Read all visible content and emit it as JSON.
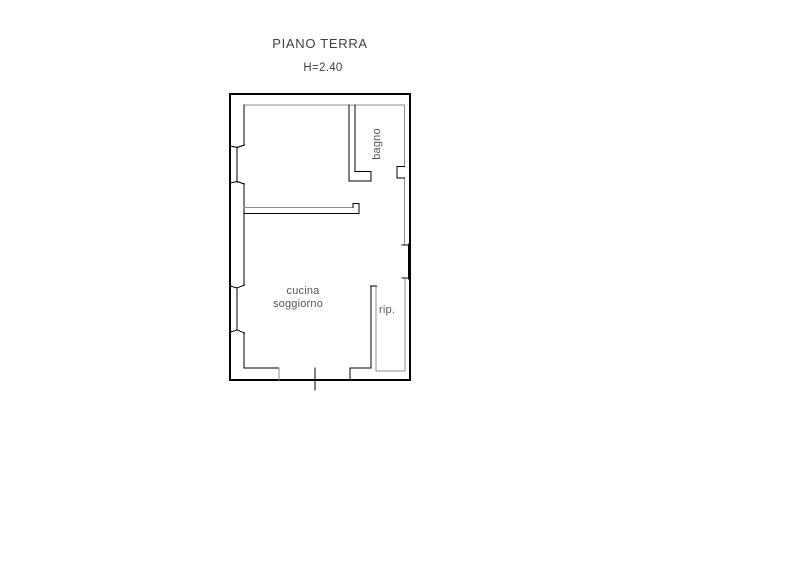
{
  "title": "PIANO TERRA",
  "subtitle": "H=2.40",
  "colors": {
    "background": "#ffffff",
    "line_main": "#000000",
    "line_secondary": "#8c8c8c",
    "text": "#3f3f3f"
  },
  "floorplan": {
    "labels": [
      {
        "id": "bagno",
        "text": "bagno"
      },
      {
        "id": "cucina",
        "text": "cucina"
      },
      {
        "id": "soggiorno",
        "text": "soggiorno"
      },
      {
        "id": "rip",
        "text": "rip."
      }
    ],
    "segments": [
      {
        "p": [
          230,
          94,
          410,
          94
        ],
        "c": "m",
        "w": 1.6,
        "part": "outer-wall-top"
      },
      {
        "p": [
          410,
          94,
          410,
          380
        ],
        "c": "m",
        "w": 1.6,
        "part": "outer-wall-right"
      },
      {
        "p": [
          410,
          380,
          230,
          380
        ],
        "c": "m",
        "w": 1.6,
        "part": "outer-wall-bottom"
      },
      {
        "p": [
          230,
          380,
          230,
          94
        ],
        "c": "m",
        "w": 1.6,
        "part": "outer-wall-left"
      },
      {
        "p": [
          244,
          105,
          404.5,
          105
        ],
        "c": "s",
        "w": 1.2,
        "part": "inner-wall-top"
      },
      {
        "p": [
          244,
          105,
          244,
          145
        ],
        "c": "m",
        "w": 1.2,
        "part": "inner-wall-left"
      },
      {
        "p": [
          244,
          184,
          244,
          285
        ],
        "c": "m",
        "w": 1.2,
        "part": "inner-wall-left"
      },
      {
        "p": [
          244,
          333,
          244,
          368
        ],
        "c": "m",
        "w": 1.2,
        "part": "inner-wall-left"
      },
      {
        "p": [
          404.5,
          105,
          404.5,
          166.5
        ],
        "c": "s",
        "w": 1.2,
        "part": "inner-wall-right"
      },
      {
        "p": [
          404.5,
          178,
          404.5,
          245
        ],
        "c": "s",
        "w": 1.2,
        "part": "inner-wall-right"
      },
      {
        "p": [
          405,
          278,
          405,
          371
        ],
        "c": "s",
        "w": 1.2,
        "part": "inner-wall-right"
      },
      {
        "p": [
          244,
          368,
          279,
          368
        ],
        "c": "m",
        "w": 1.2,
        "part": "inner-wall-bottom"
      },
      {
        "p": [
          279,
          368,
          279,
          380
        ],
        "c": "s",
        "w": 1.2,
        "part": "entrance-jamb-left"
      },
      {
        "p": [
          350,
          368,
          350,
          380
        ],
        "c": "m",
        "w": 1.2,
        "part": "entrance-jamb-right"
      },
      {
        "p": [
          350,
          368,
          371,
          368
        ],
        "c": "m",
        "w": 1.2,
        "part": "inner-wall-bottom"
      },
      {
        "p": [
          376,
          371,
          405,
          371
        ],
        "c": "s",
        "w": 1.2,
        "part": "closet-floor-line"
      },
      {
        "p": [
          315,
          368,
          315,
          390
        ],
        "c": "m",
        "w": 1.2,
        "part": "entrance-door-axis"
      },
      {
        "p": [
          237,
          147,
          237,
          182
        ],
        "c": "m",
        "w": 1.1,
        "part": "window-1-pane"
      },
      {
        "p": [
          230.5,
          146,
          237,
          147.5
        ],
        "c": "m",
        "w": 1.0,
        "part": "window-1-jamb-top"
      },
      {
        "p": [
          237,
          147.5,
          244.5,
          145
        ],
        "c": "m",
        "w": 1.0,
        "part": "window-1-jamb-top"
      },
      {
        "p": [
          237,
          181.5,
          244.5,
          184
        ],
        "c": "m",
        "w": 1.0,
        "part": "window-1-jamb-bottom"
      },
      {
        "p": [
          230.5,
          183,
          237,
          181.5
        ],
        "c": "m",
        "w": 1.0,
        "part": "window-1-jamb-bottom"
      },
      {
        "p": [
          237,
          288,
          237,
          330
        ],
        "c": "m",
        "w": 1.1,
        "part": "window-2-pane"
      },
      {
        "p": [
          230.5,
          286,
          237,
          288
        ],
        "c": "m",
        "w": 1.0,
        "part": "window-2-jamb-top"
      },
      {
        "p": [
          237,
          288,
          244.5,
          285
        ],
        "c": "m",
        "w": 1.0,
        "part": "window-2-jamb-top"
      },
      {
        "p": [
          237,
          330,
          244.5,
          333
        ],
        "c": "m",
        "w": 1.0,
        "part": "window-2-jamb-bottom"
      },
      {
        "p": [
          230.5,
          332,
          237,
          330
        ],
        "c": "m",
        "w": 1.0,
        "part": "window-2-jamb-bottom"
      },
      {
        "p": [
          349,
          105,
          349,
          181
        ],
        "c": "m",
        "w": 1.3,
        "part": "bagno-wall"
      },
      {
        "p": [
          349,
          181,
          371,
          181
        ],
        "c": "m",
        "w": 1.3,
        "part": "bagno-wall-foot"
      },
      {
        "p": [
          371,
          181,
          371,
          171.5
        ],
        "c": "m",
        "w": 1.2,
        "part": "bagno-wall-foot"
      },
      {
        "p": [
          371,
          171.5,
          355,
          171.5
        ],
        "c": "m",
        "w": 1.2,
        "part": "bagno-wall-foot"
      },
      {
        "p": [
          355,
          171.5,
          355,
          105
        ],
        "c": "m",
        "w": 1.2,
        "part": "bagno-wall"
      },
      {
        "p": [
          244,
          207.5,
          353,
          207.5
        ],
        "c": "s",
        "w": 1.2,
        "part": "mid-wall-top"
      },
      {
        "p": [
          244,
          213.5,
          359,
          213.5
        ],
        "c": "m",
        "w": 1.3,
        "part": "mid-wall-bottom"
      },
      {
        "p": [
          359,
          213.5,
          359,
          203.5
        ],
        "c": "m",
        "w": 1.2,
        "part": "mid-wall-end-hook"
      },
      {
        "p": [
          359,
          203.5,
          353,
          203.5
        ],
        "c": "m",
        "w": 1.2,
        "part": "mid-wall-end-hook"
      },
      {
        "p": [
          353,
          203.5,
          353,
          207.5
        ],
        "c": "m",
        "w": 1.2,
        "part": "mid-wall-end-hook"
      },
      {
        "p": [
          371,
          286,
          371,
          368
        ],
        "c": "m",
        "w": 1.2,
        "part": "rip-closet-wall"
      },
      {
        "p": [
          376,
          286,
          376,
          371
        ],
        "c": "s",
        "w": 1.2,
        "part": "rip-closet-wall"
      },
      {
        "p": [
          370.5,
          286,
          376.5,
          286
        ],
        "c": "m",
        "w": 1.2,
        "part": "rip-closet-wall-cap"
      },
      {
        "p": [
          402,
          245,
          409,
          245
        ],
        "c": "m",
        "w": 1.1,
        "part": "right-opening-tick-top"
      },
      {
        "p": [
          409.5,
          245,
          409.5,
          278
        ],
        "c": "m",
        "w": 3.0,
        "part": "right-opening-frame"
      },
      {
        "p": [
          402,
          278,
          409,
          278
        ],
        "c": "m",
        "w": 1.1,
        "part": "right-opening-tick-bottom"
      },
      {
        "p": [
          404.5,
          166.5,
          397,
          166.5
        ],
        "c": "m",
        "w": 1.1,
        "part": "bagno-niche"
      },
      {
        "p": [
          397,
          166.5,
          397,
          178
        ],
        "c": "m",
        "w": 1.1,
        "part": "bagno-niche"
      },
      {
        "p": [
          397,
          178,
          404.5,
          178
        ],
        "c": "m",
        "w": 1.1,
        "part": "bagno-niche"
      }
    ]
  }
}
